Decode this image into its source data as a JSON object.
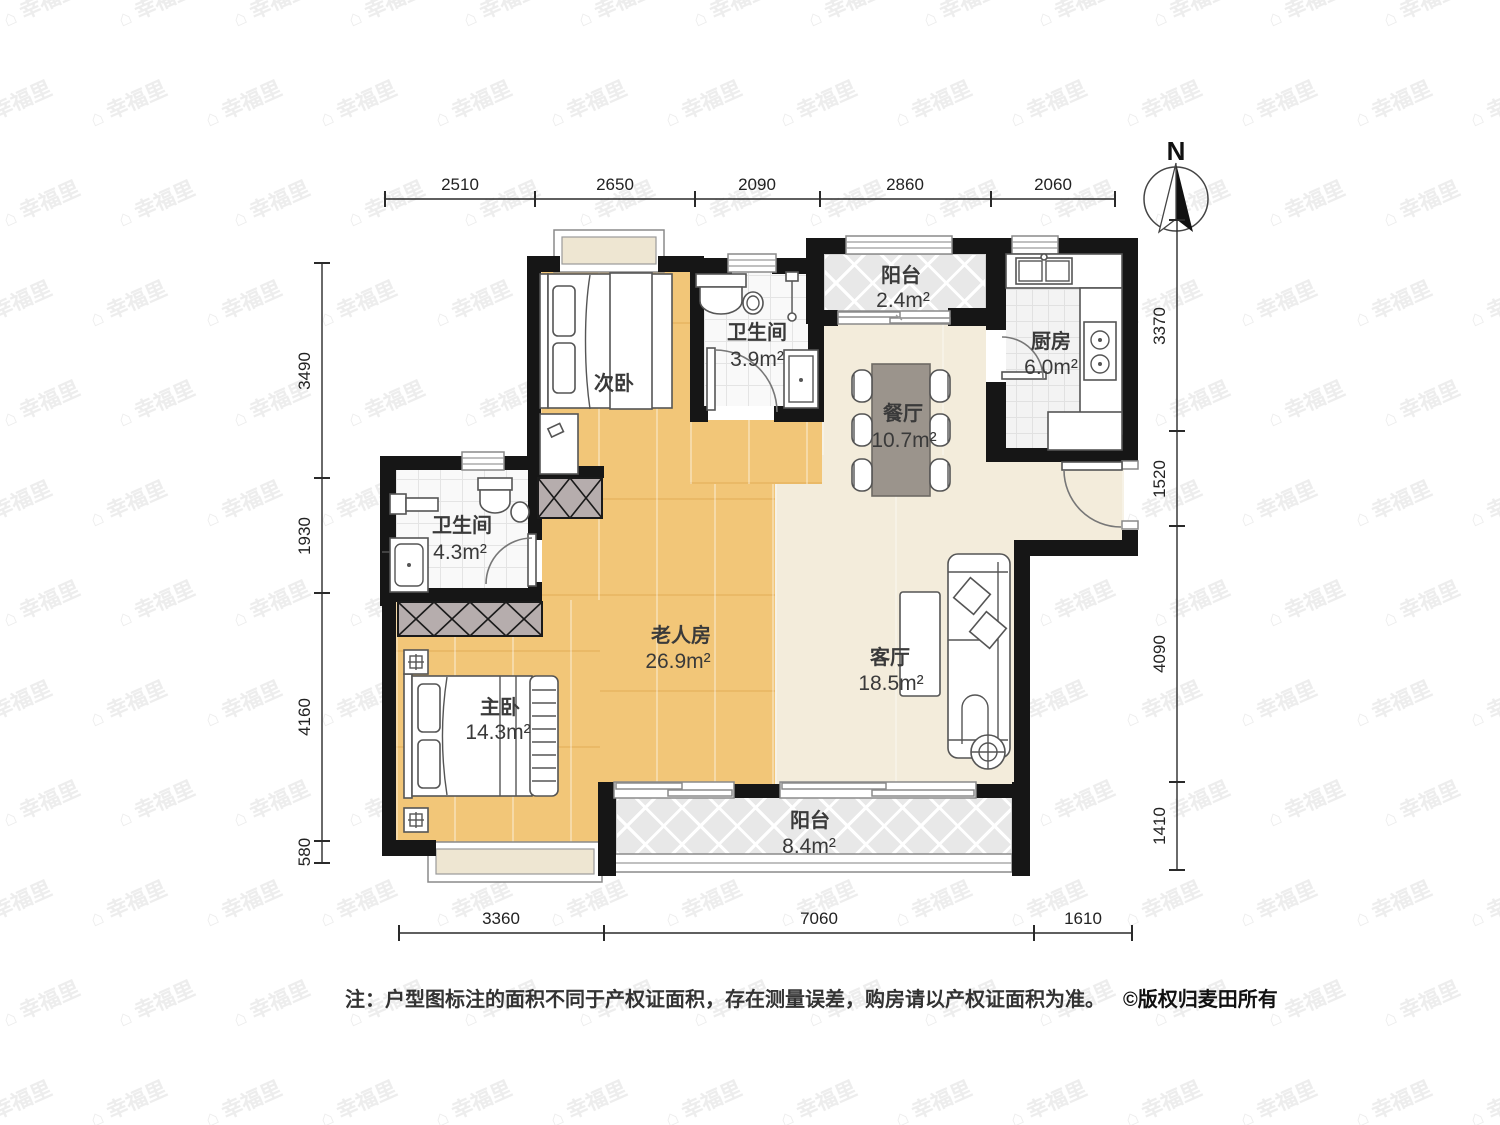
{
  "watermark": {
    "text": "幸福里",
    "icon": "house-icon",
    "icon_glyph": "⌂"
  },
  "north": {
    "label": "N"
  },
  "dimensions": {
    "top": [
      "2510",
      "2650",
      "2090",
      "2860",
      "2060"
    ],
    "bottom": [
      "3360",
      "7060",
      "1610"
    ],
    "left": [
      "3490",
      "1930",
      "4160",
      "580"
    ],
    "right": [
      "3370",
      "1520",
      "4090",
      "1410"
    ]
  },
  "rooms": [
    {
      "name": "阳台",
      "area": "2.4m²"
    },
    {
      "name": "厨房",
      "area": "6.0m²"
    },
    {
      "name": "卫生间",
      "area": "3.9m²"
    },
    {
      "name": "次卧",
      "area": ""
    },
    {
      "name": "餐厅",
      "area": "10.7m²"
    },
    {
      "name": "卫生间",
      "area": "4.3m²"
    },
    {
      "name": "老人房",
      "area": "26.9m²"
    },
    {
      "name": "客厅",
      "area": "18.5m²"
    },
    {
      "name": "主卧",
      "area": "14.3m²"
    },
    {
      "name": "阳台",
      "area": "8.4m²"
    }
  ],
  "note": {
    "text": "注：户型图标注的面积不同于产权证面积，存在测量误差，购房请以产权证面积为准。",
    "copyright": "©版权归麦田所有"
  },
  "colors": {
    "wall": "#161616",
    "wood_floor": "#f2c678",
    "living_floor": "#f3ecdb",
    "dining_table": "#9b948c",
    "wardrobe": "#b6adad",
    "watermark": "#ededed"
  }
}
